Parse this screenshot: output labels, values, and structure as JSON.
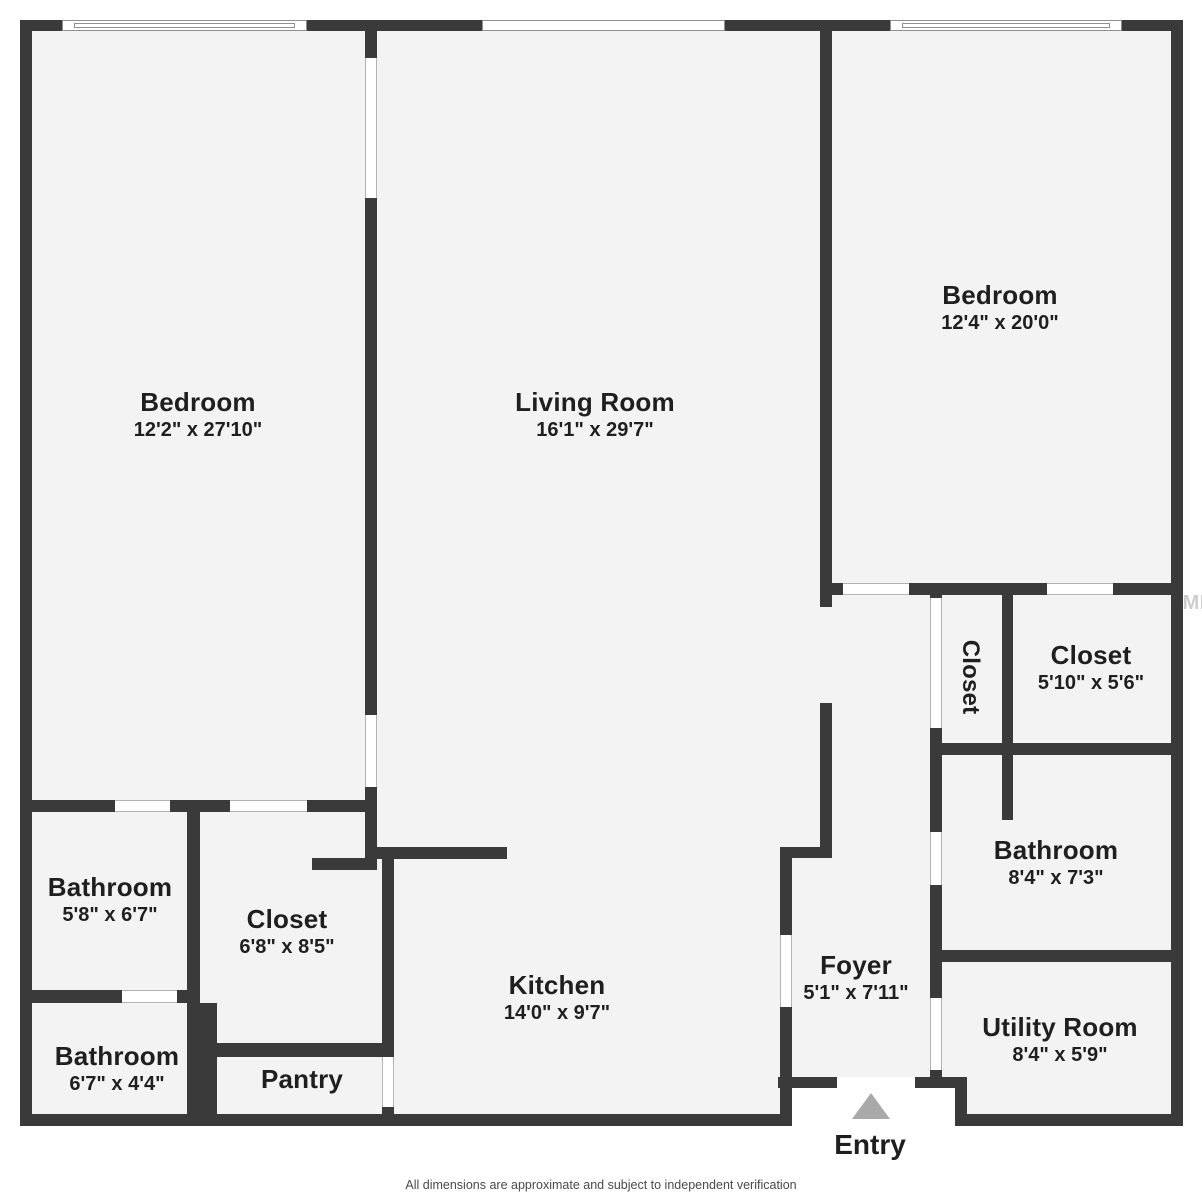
{
  "page": {
    "footer": "All dimensions are approximate and subject to independent verification",
    "watermark": "StellarMLS",
    "colors": {
      "wall": "#3a3a3a",
      "floor": "#f3f3f3",
      "outside": "#ffffff",
      "text": "#1f1f1f",
      "entry_arrow": "#a9a9a9",
      "jamb_line": "#b3b3b3",
      "window_frame": "#8f8f8f"
    }
  },
  "entry": {
    "label": "Entry"
  },
  "rooms": [
    {
      "id": "bedroom-left",
      "name": "Bedroom",
      "dims": "12'2\" x 27'10\"",
      "x": 198,
      "y": 415
    },
    {
      "id": "living-room",
      "name": "Living Room",
      "dims": "16'1\" x 29'7\"",
      "x": 595,
      "y": 415
    },
    {
      "id": "bedroom-right",
      "name": "Bedroom",
      "dims": "12'4\" x 20'0\"",
      "x": 1000,
      "y": 308
    },
    {
      "id": "closet-hall",
      "name": "Closet",
      "dims": "",
      "x": 970,
      "y": 677,
      "vertical": true
    },
    {
      "id": "closet-right",
      "name": "Closet",
      "dims": "5'10\" x 5'6\"",
      "x": 1091,
      "y": 668
    },
    {
      "id": "bathroom-right",
      "name": "Bathroom",
      "dims": "8'4\" x 7'3\"",
      "x": 1056,
      "y": 863
    },
    {
      "id": "utility-room",
      "name": "Utility Room",
      "dims": "8'4\" x 5'9\"",
      "x": 1060,
      "y": 1040
    },
    {
      "id": "foyer",
      "name": "Foyer",
      "dims": "5'1\" x 7'11\"",
      "x": 856,
      "y": 978
    },
    {
      "id": "kitchen",
      "name": "Kitchen",
      "dims": "14'0\" x 9'7\"",
      "x": 557,
      "y": 998
    },
    {
      "id": "closet-left",
      "name": "Closet",
      "dims": "6'8\" x 8'5\"",
      "x": 287,
      "y": 932
    },
    {
      "id": "bathroom-top-left",
      "name": "Bathroom",
      "dims": "5'8\" x 6'7\"",
      "x": 110,
      "y": 900
    },
    {
      "id": "bathroom-bottom-left",
      "name": "Bathroom",
      "dims": "6'7\" x 4'4\"",
      "x": 117,
      "y": 1069
    },
    {
      "id": "pantry",
      "name": "Pantry",
      "dims": "",
      "x": 302,
      "y": 1079
    }
  ],
  "geometry": {
    "floors": [
      [
        32,
        31,
        760,
        1085
      ],
      [
        792,
        31,
        175,
        1046
      ],
      [
        967,
        31,
        204,
        1085
      ]
    ],
    "walls": [
      [
        20,
        20,
        1163,
        11
      ],
      [
        20,
        20,
        12,
        1106
      ],
      [
        1171,
        20,
        12,
        1106
      ],
      [
        20,
        1114,
        772,
        12
      ],
      [
        955,
        1114,
        228,
        12
      ],
      [
        778,
        1077,
        189,
        11
      ],
      [
        955,
        1077,
        12,
        49
      ],
      [
        780,
        847,
        12,
        279
      ],
      [
        365,
        31,
        12,
        827
      ],
      [
        32,
        800,
        345,
        12
      ],
      [
        377,
        847,
        130,
        12
      ],
      [
        312,
        858,
        65,
        12
      ],
      [
        382,
        858,
        12,
        268
      ],
      [
        187,
        812,
        13,
        191
      ],
      [
        32,
        990,
        168,
        13
      ],
      [
        187,
        1003,
        30,
        111
      ],
      [
        187,
        1043,
        207,
        14
      ],
      [
        820,
        20,
        12,
        587
      ],
      [
        820,
        703,
        12,
        144
      ],
      [
        780,
        847,
        52,
        11
      ],
      [
        820,
        583,
        363,
        12
      ],
      [
        930,
        583,
        12,
        505
      ],
      [
        1002,
        583,
        11,
        237
      ],
      [
        930,
        743,
        253,
        12
      ],
      [
        930,
        950,
        253,
        12
      ]
    ],
    "openings": [
      [
        365,
        58,
        12,
        140,
        "v"
      ],
      [
        365,
        715,
        12,
        72,
        "v"
      ],
      [
        115,
        800,
        55,
        12,
        "h"
      ],
      [
        230,
        800,
        77,
        12,
        "h"
      ],
      [
        382,
        1057,
        12,
        50,
        "v"
      ],
      [
        122,
        990,
        55,
        13,
        "h"
      ],
      [
        843,
        583,
        66,
        12,
        "h"
      ],
      [
        1047,
        583,
        66,
        12,
        "h"
      ],
      [
        930,
        598,
        12,
        130,
        "v"
      ],
      [
        930,
        832,
        12,
        53,
        "v"
      ],
      [
        930,
        998,
        12,
        72,
        "v"
      ],
      [
        837,
        1077,
        78,
        11,
        "none"
      ],
      [
        780,
        935,
        12,
        72,
        "v"
      ]
    ],
    "windows": [
      [
        62,
        20,
        245,
        11,
        "double"
      ],
      [
        482,
        20,
        243,
        11,
        "plain"
      ],
      [
        890,
        20,
        232,
        11,
        "double"
      ]
    ]
  }
}
